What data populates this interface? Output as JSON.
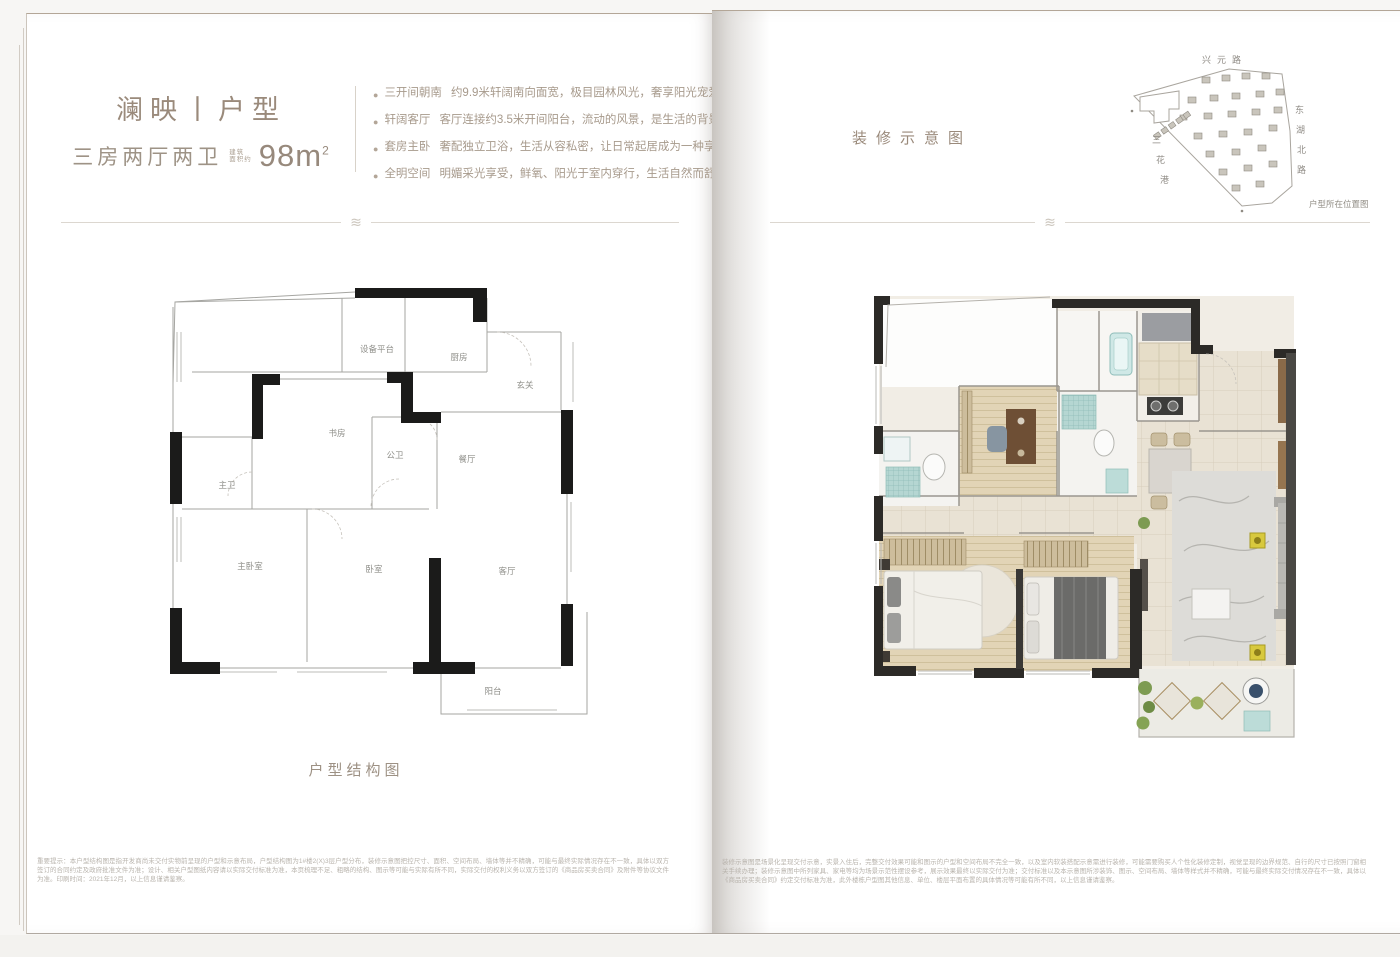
{
  "colors": {
    "title_taupe": "#9a8a7b",
    "body_taupe": "#a79a8c",
    "plan_wall_black": "#1b1b1a",
    "render_wall_dark": "#2c2a27",
    "teal_fixture": "#a7cdc9",
    "wood_floor": "#e2d4b6",
    "page_white": "#ffffff"
  },
  "ornament_glyph": "≋",
  "left_page": {
    "title": "澜映丨户型",
    "subtitle": "三房两厅两卫",
    "area_note_top": "建筑",
    "area_note_bottom": "面积约",
    "area_value": "98m",
    "area_sup": "2",
    "bullets": [
      {
        "head": "三开间朝南",
        "body": "约9.9米轩阔南向面宽，极目园林风光，奢享阳光宠爱"
      },
      {
        "head": "轩阔客厅",
        "body": "客厅连接约3.5米开间阳台，流动的风景，是生活的背景"
      },
      {
        "head": "套房主卧",
        "body": "奢配独立卫浴，生活从容私密，让日常起居成为一种享受"
      },
      {
        "head": "全明空间",
        "body": "明媚采光享受，鲜氧、阳光于室内穿行，生活自然而舒畅"
      }
    ],
    "plan_caption": "户型结构图",
    "rooms": {
      "equipment_platform": "设备平台",
      "kitchen": "厨房",
      "foyer": "玄关",
      "study": "书房",
      "guest_bath": "公卫",
      "dining": "餐厅",
      "master_bath": "主卫",
      "master_bedroom": "主卧室",
      "bedroom": "卧室",
      "living": "客厅",
      "balcony": "阳台"
    },
    "disclaimer": "重要提示：本户型结构图是指开发商尚未交付实物前呈现的户型和示意布局，户型结构图为1#楼2(X)3层户型分布，装修示意图把控尺寸、面积、空间布局、墙体等并不精确，可能与最终实际情况存在不一致，具体以双方签订的合同约定及政府批准文件为准；设计、相关户型图纸内容请以实际交付标准为准，本页梳理不足、粗略的结构、图示等可能与实际有所不同，实际交付的权利义务以双方签订的《商品房买卖合同》及附件等协议文件为准。印刷时间：2021年12月，以上信息谨请鉴察。"
  },
  "right_page": {
    "title": "装修示意图",
    "map": {
      "road_top": "兴元路",
      "road_right_chars": [
        "东",
        "湖",
        "北",
        "路"
      ],
      "road_left_chars": [
        "三",
        "花",
        "港"
      ],
      "caption": "户型所在位置图"
    },
    "disclaimer": "装修示意图是场景化呈现交付示意，实景入住后，完整交付效果可能和图示的户型和空间布局不完全一致，以及室内软装搭配示意需进行装修，可能需要购买人个性化装修定制，视觉呈现的边界规范、自行的尺寸已按照门窗相关手续办理；装修示意图中所列家具、家电等均为场景示范性摆设参考，展示效果最终以实际交付为准；交付标准以及本示意图所涉装饰、图示、空间布局、墙体等样式并不精确，可能与最终实际交付情况存在不一致，具体以《商品房买卖合同》约定交付标准为准，此外楼栋户型图其他信息、单位、楼层平面布置的具体情况等可能有所不同，以上信息谨请鉴察。"
  }
}
